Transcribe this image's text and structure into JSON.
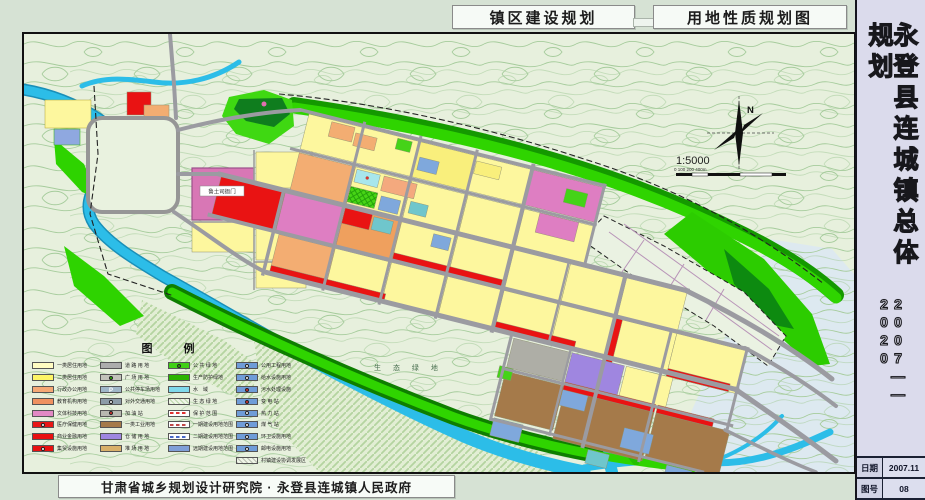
{
  "header": {
    "title_left": "镇区建设规划",
    "title_right": "用地性质规划图"
  },
  "sidebar": {
    "title_vertical": "永登县连城镇总体规划",
    "period": "2007——2020",
    "info": {
      "date_label": "日期",
      "date_value": "2007.11",
      "sheet_label": "图号",
      "sheet_value": "08"
    }
  },
  "footer": {
    "credit": "甘肃省城乡规划设计研究院 · 永登县连城镇人民政府"
  },
  "map": {
    "compass_label": "N",
    "scale_text": "1:5000",
    "scale_ticks": "0   100    200                400m",
    "labels": {
      "yamen": "鲁土司衙门",
      "eco_green": "生 态 绿 地"
    }
  },
  "legend": {
    "title": "图 例",
    "columns": [
      {
        "items": [
          {
            "label": "一类居住用地",
            "color": "#fffcc2",
            "type": "swatch"
          },
          {
            "label": "二类居住用地",
            "color": "#fdf566",
            "type": "swatch"
          },
          {
            "label": "行政办公用地",
            "color": "#f5a875",
            "type": "swatch"
          },
          {
            "label": "教育机构用地",
            "color": "#ef9160",
            "type": "swatch"
          },
          {
            "label": "文体科技用地",
            "color": "#e289c4",
            "type": "swatch"
          },
          {
            "label": "医疗保健用地",
            "color": "#e81616",
            "type": "swatch",
            "icon": "dot"
          },
          {
            "label": "商业金融用地",
            "color": "#e81010",
            "type": "swatch"
          },
          {
            "label": "集贸设施用地",
            "color": "#e81010",
            "type": "swatch",
            "icon": "dot"
          }
        ]
      },
      {
        "items": [
          {
            "label": "道 路 用 地",
            "color": "#acacac",
            "type": "swatch"
          },
          {
            "label": "广 场 用 地",
            "color": "#c2c2ba",
            "type": "swatch",
            "icon": "dot-green"
          },
          {
            "label": "公共停车场用地",
            "color": "#9fb6c8",
            "type": "swatch",
            "icon": "P"
          },
          {
            "label": "对外交通用地",
            "color": "#8c9ca8",
            "type": "swatch",
            "icon": "dot"
          },
          {
            "label": "加 油 站",
            "color": "#b8b8b0",
            "type": "swatch",
            "icon": "dot-red"
          },
          {
            "label": "一类工业用地",
            "color": "#a57a4a",
            "type": "swatch"
          },
          {
            "label": "仓 储 用 地",
            "color": "#9f86e0",
            "type": "swatch"
          },
          {
            "label": "堆 场 用 地",
            "color": "#d9b06a",
            "type": "swatch"
          }
        ]
      },
      {
        "items": [
          {
            "label": "公 共 绿 地",
            "color": "#3fd014",
            "type": "swatch",
            "icon": "dot-green"
          },
          {
            "label": "生产防护绿地",
            "color": "#2bb400",
            "type": "swatch"
          },
          {
            "label": "水　域",
            "color": "#7fd9ec",
            "type": "swatch"
          },
          {
            "label": "生 态 绿 地",
            "color": "#bcd8aa",
            "type": "hatch"
          },
          {
            "label": "保 护 范 围",
            "color": "#e03030",
            "type": "dashed"
          },
          {
            "label": "一期建设用地范围",
            "color": "#c04848",
            "type": "dashed"
          },
          {
            "label": "二期建设用地范围",
            "color": "#4868c8",
            "type": "dashed"
          },
          {
            "label": "远期建设用地范围",
            "color": "#7f9fd8",
            "type": "swatch"
          }
        ]
      },
      {
        "items": [
          {
            "label": "公用工程用地",
            "color": "#6f9cd8",
            "type": "swatch",
            "icon": "dot"
          },
          {
            "label": "给水设施用地",
            "color": "#6f9cd8",
            "type": "swatch",
            "icon": "dot"
          },
          {
            "label": "污水处理设施",
            "color": "#6f9cd8",
            "type": "swatch",
            "icon": "dot-red"
          },
          {
            "label": "变 电 站",
            "color": "#6f9cd8",
            "type": "swatch",
            "icon": "dot-red"
          },
          {
            "label": "热 力 站",
            "color": "#6f9cd8",
            "type": "swatch",
            "icon": "dot"
          },
          {
            "label": "煤 气 站",
            "color": "#6f9cd8",
            "type": "swatch",
            "icon": "dot"
          },
          {
            "label": "环卫设施用地",
            "color": "#6f9cd8",
            "type": "swatch",
            "icon": "dot"
          },
          {
            "label": "邮电设施用地",
            "color": "#6f9cd8",
            "type": "swatch",
            "icon": "dot"
          },
          {
            "label": "村镇建设协调发展区",
            "color": "#b9bdb0",
            "type": "hatch"
          }
        ]
      }
    ]
  }
}
